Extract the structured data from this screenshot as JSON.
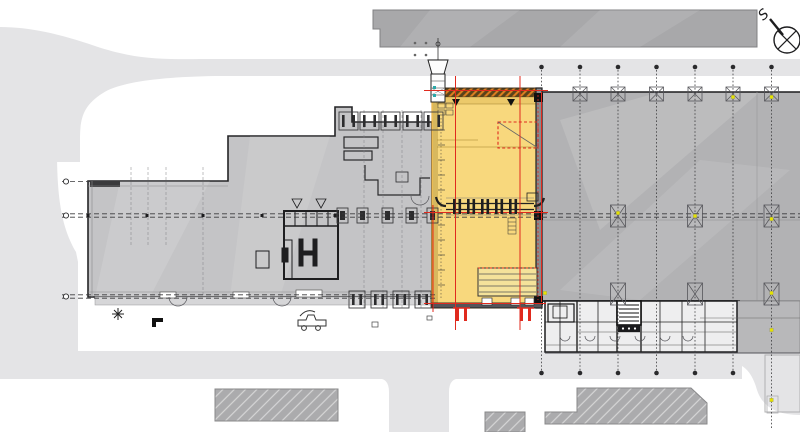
{
  "compass": {
    "label": "S"
  },
  "palette": {
    "background": "#ffffff",
    "road": "#e4e4e6",
    "building_top": "#a8a8aa",
    "building_left": "#c4c4c6",
    "building_right": "#b2b2b4",
    "building_annex": "#b8b8ba",
    "building_hatched": "#ababad",
    "highlight_fill": "#f8d87d",
    "highlight_edge": "#e0a029",
    "red_line": "#e02a1e",
    "grid_line": "#3a3a3c",
    "yellow_marker": "#e5e300",
    "outline_dark": "#242426",
    "wall_dark": "#161618"
  },
  "grid": {
    "verticals": [
      541.5,
      580,
      618,
      656.5,
      695,
      733
    ],
    "vertical_tall": 771.5,
    "top_y": 67,
    "bottom_y": 373,
    "tall_bottom_y": 430,
    "red_verticals": [
      {
        "x": 433,
        "y1": 205,
        "y2": 312
      },
      {
        "x": 455.5,
        "y1": 76,
        "y2": 330
      },
      {
        "x": 520,
        "y1": 76,
        "y2": 330
      },
      {
        "x": 541.5,
        "y1": 92,
        "y2": 302
      }
    ],
    "red_horizontals": [
      {
        "y": 90.5,
        "x1": 424,
        "x2": 548
      },
      {
        "y": 212.5,
        "x1": 424,
        "x2": 548
      },
      {
        "y": 303.5,
        "x1": 424,
        "x2": 546
      }
    ],
    "h_dashed": [
      {
        "y": 181.5,
        "x1": 62,
        "x2": 90
      },
      {
        "y": 213.8,
        "x1": 62,
        "x2": 800
      },
      {
        "y": 217.2,
        "x1": 62,
        "x2": 800
      },
      {
        "y": 294.8,
        "x1": 62,
        "x2": 436
      },
      {
        "y": 298.2,
        "x1": 62,
        "x2": 436
      }
    ],
    "axis_markers": [
      {
        "x": 66,
        "y": 181.5
      },
      {
        "x": 66,
        "y": 215.5
      },
      {
        "x": 66,
        "y": 296.5
      }
    ],
    "intersection_dots": [
      [
        88,
        215.5
      ],
      [
        147,
        215.5
      ],
      [
        203,
        215.5
      ],
      [
        262,
        215.5
      ],
      [
        335,
        215.5
      ],
      [
        433,
        215.5
      ]
    ],
    "faint_verticals": [
      {
        "x": 131,
        "y1": 167,
        "y2": 245
      },
      {
        "x": 148,
        "y1": 167,
        "y2": 245
      },
      {
        "x": 166,
        "y1": 167,
        "y2": 245
      },
      {
        "x": 203,
        "y1": 167,
        "y2": 296
      },
      {
        "x": 364,
        "y1": 110,
        "y2": 308
      },
      {
        "x": 383,
        "y1": 110,
        "y2": 308
      },
      {
        "x": 402,
        "y1": 110,
        "y2": 308
      },
      {
        "x": 421,
        "y1": 110,
        "y2": 308
      }
    ]
  },
  "columns": {
    "top": {
      "cy": 94,
      "h": 14,
      "w": 14,
      "xs": [
        580,
        618,
        656.5,
        695,
        733,
        771.5
      ]
    },
    "mid": {
      "cy": 216,
      "h": 22,
      "w": 15,
      "xs": [
        618,
        695,
        771.5
      ]
    },
    "low": {
      "cy": 294,
      "h": 22,
      "w": 15,
      "xs": [
        618,
        695,
        771.5
      ]
    }
  },
  "yellow_markers": [
    [
      733,
      97
    ],
    [
      771.5,
      97
    ],
    [
      618,
      213
    ],
    [
      695,
      216
    ],
    [
      771.5,
      219
    ],
    [
      771.5,
      293
    ],
    [
      771.5,
      330
    ],
    [
      771.5,
      400
    ],
    [
      545,
      293
    ]
  ],
  "bays": {
    "top": {
      "y": 112,
      "h": 18,
      "w": 19,
      "xs": [
        339,
        360,
        381,
        403,
        424
      ]
    },
    "mid": {
      "y": 208,
      "h": 15,
      "w": 11,
      "xs": [
        337,
        357,
        382,
        406,
        427
      ]
    },
    "bottom": {
      "y": 291,
      "h": 17,
      "w": 16,
      "xs": [
        349,
        371,
        393,
        415
      ]
    }
  },
  "red_rail_symbols": [
    {
      "x": 453,
      "y": 308,
      "w": 17
    },
    {
      "x": 517,
      "y": 308,
      "w": 17
    }
  ],
  "door_arcs": [
    {
      "x": 178,
      "y": 297,
      "r": 9
    },
    {
      "x": 282,
      "y": 297,
      "r": 9
    },
    {
      "x": 420,
      "y": 196,
      "r": 9
    },
    {
      "x": 565,
      "y": 336,
      "r": 5
    },
    {
      "x": 590,
      "y": 336,
      "r": 5
    },
    {
      "x": 615,
      "y": 336,
      "r": 5
    },
    {
      "x": 640,
      "y": 336,
      "r": 5
    },
    {
      "x": 665,
      "y": 336,
      "r": 5
    },
    {
      "x": 688,
      "y": 336,
      "r": 5
    }
  ],
  "conveyor": {
    "y_top": 203.5,
    "y_bot": 209.5,
    "x1": 446,
    "x2": 534,
    "ticks": [
      457,
      471,
      485,
      499,
      513
    ]
  },
  "chute_dots": [
    [
      415,
      43
    ],
    [
      426,
      43
    ],
    [
      415,
      55
    ],
    [
      426,
      55
    ]
  ]
}
